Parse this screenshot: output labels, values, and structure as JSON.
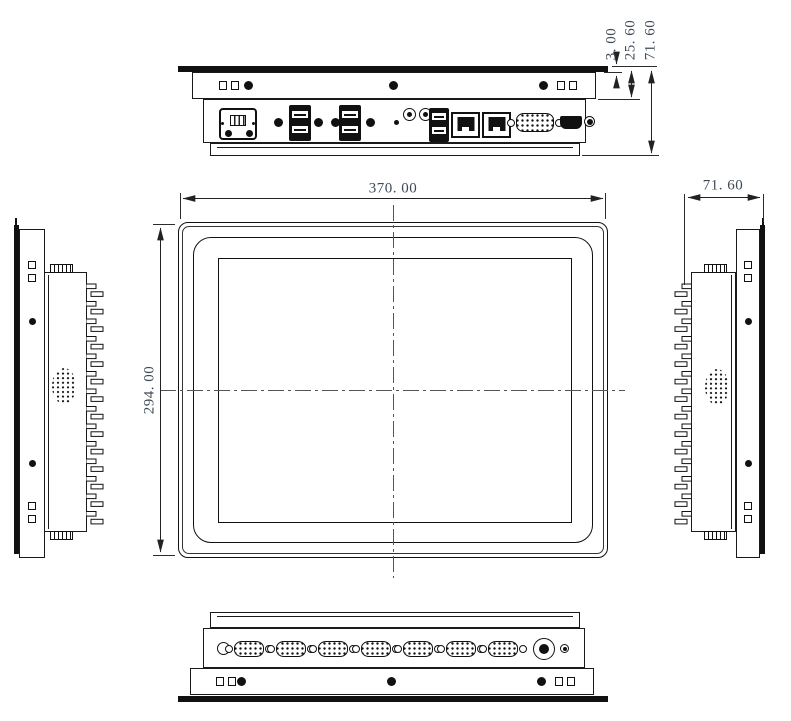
{
  "colors": {
    "background": "#ffffff",
    "line_ink": "#1a1a1a",
    "dimension_text": "#3e4a57"
  },
  "dimensions": {
    "front_width": "370. 00",
    "front_height": "294. 00",
    "side_depth": "71. 60",
    "bezel_thickness": "3. 00",
    "bezel_to_mount_flange": "25. 60",
    "total_depth": "71. 60"
  }
}
